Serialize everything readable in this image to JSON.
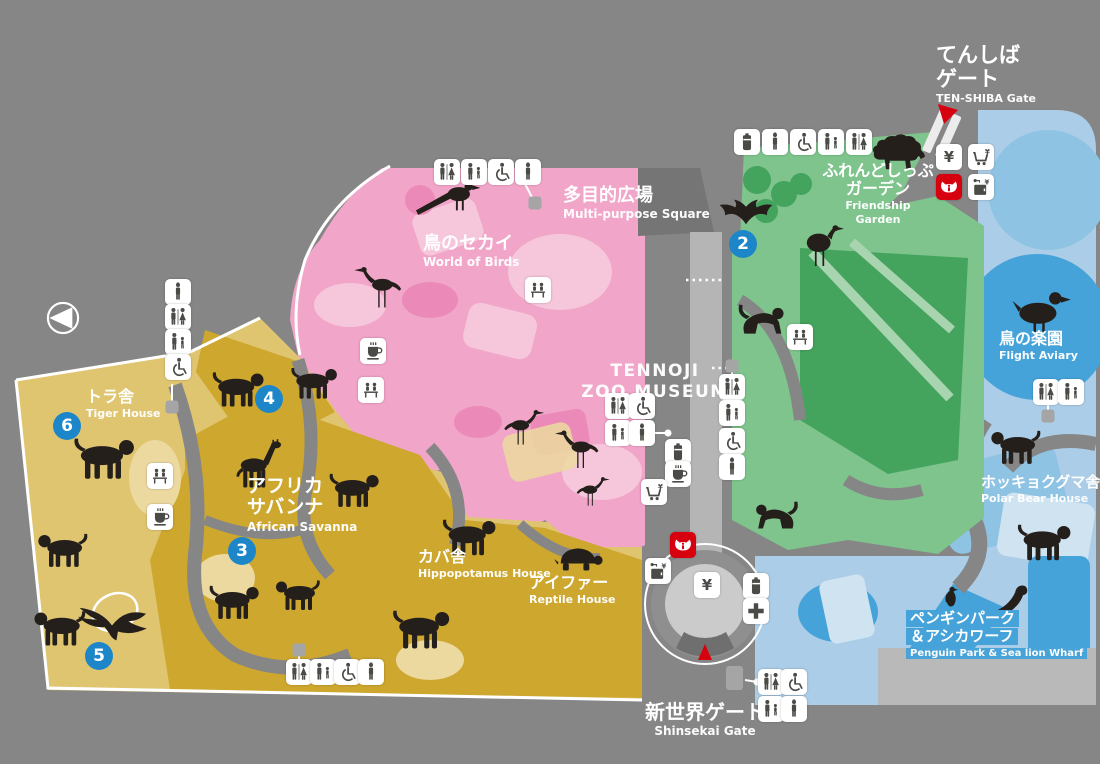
{
  "map": {
    "name": "Tennoji Zoo guide map",
    "colors": {
      "bg": "#868686",
      "corridor_dark": "#757575",
      "road_light": "#b5b5b5",
      "plaza_ring": "#8f8f8f",
      "plaza_inner": "#cbcbcb",
      "plaza_steps": "#6f6f6f",
      "concrete": "#b9b9b9",
      "pink": "#f1a5c9",
      "pink_light": "#f6c6db",
      "pink_dark": "#eb8ab8",
      "yellow": "#cda72e",
      "yellow_light": "#e0c571",
      "yellow_pale": "#ecd99f",
      "green": "#7ec48c",
      "green_dark": "#44a35d",
      "green_pale": "#a8d5b0",
      "blue_bg": "#abcde7",
      "blue_mid": "#45a3da",
      "blue_soft": "#8fc3e4",
      "blue_pale": "#cfe3f1",
      "ink": "#241f1b",
      "glyph": "#4a4a46",
      "marker_blue": "#1d86c8",
      "red": "#d7000f"
    },
    "compass": {
      "x": 63,
      "y": 318
    },
    "labels": [
      {
        "id": "tenshiba-gate",
        "ja": [
          "てんしば",
          "ゲート"
        ],
        "en": "TEN-SHIBA Gate",
        "x": 936,
        "y": 44,
        "ja_size": 21,
        "en_size": 11,
        "align": "left"
      },
      {
        "id": "friendship-garden",
        "ja": [
          "ふれんどしっぷ",
          "ガーデン"
        ],
        "en": [
          "Friendship",
          "Garden"
        ],
        "x": 878,
        "y": 162,
        "ja_size": 16,
        "en_size": 11,
        "align": "center"
      },
      {
        "id": "multi-purpose-square",
        "ja": [
          "多目的広場"
        ],
        "en": "Multi-purpose Square",
        "x": 563,
        "y": 186,
        "ja_size": 18,
        "en_size": 12,
        "align": "left"
      },
      {
        "id": "world-of-birds",
        "ja": [
          "鳥のセカイ"
        ],
        "en": "World of Birds",
        "x": 423,
        "y": 234,
        "ja_size": 18,
        "en_size": 12,
        "align": "left"
      },
      {
        "id": "zoo-museum",
        "ja": [],
        "en": [
          "TENNOJI",
          "ZOO MUSEUM"
        ],
        "x": 655,
        "y": 360,
        "ja_size": 0,
        "en_size": 17,
        "align": "center"
      },
      {
        "id": "tiger-house",
        "ja": [
          "トラ舎"
        ],
        "en": "Tiger House",
        "x": 86,
        "y": 388,
        "ja_size": 16,
        "en_size": 11,
        "align": "left"
      },
      {
        "id": "african-savanna",
        "ja": [
          "アフリカ",
          "サバンナ"
        ],
        "en": "African Savanna",
        "x": 247,
        "y": 476,
        "ja_size": 19,
        "en_size": 12,
        "align": "left"
      },
      {
        "id": "hippopotamus-house",
        "ja": [
          "カバ舎"
        ],
        "en": "Hippopotamus House",
        "x": 418,
        "y": 548,
        "ja_size": 16,
        "en_size": 11,
        "align": "left"
      },
      {
        "id": "reptile-house",
        "ja": [
          "アイファー"
        ],
        "en": "Reptile House",
        "x": 529,
        "y": 574,
        "ja_size": 16,
        "en_size": 11,
        "align": "left"
      },
      {
        "id": "flight-aviary",
        "ja": [
          "鳥の楽園"
        ],
        "en": "Flight Aviary",
        "x": 999,
        "y": 330,
        "ja_size": 16,
        "en_size": 11,
        "align": "left"
      },
      {
        "id": "polar-bear-house",
        "ja": [
          "ホッキョクグマ舎"
        ],
        "en": "Polar Bear House",
        "x": 981,
        "y": 474,
        "ja_size": 15,
        "en_size": 11,
        "align": "left"
      },
      {
        "id": "penguin-park",
        "ja": [
          "ペンギンパーク",
          "＆アシカワーフ"
        ],
        "en": "Penguin Park & Sea lion Wharf",
        "x": 906,
        "y": 610,
        "ja_size": 15,
        "en_size": 10,
        "align": "left",
        "highlight": true
      },
      {
        "id": "shinsekai-gate",
        "ja": [
          "新世界ゲート"
        ],
        "en": "Shinsekai Gate",
        "x": 705,
        "y": 701,
        "ja_size": 20,
        "en_size": 12,
        "align": "center"
      }
    ],
    "markers": [
      {
        "n": "2",
        "x": 743,
        "y": 244
      },
      {
        "n": "3",
        "x": 242,
        "y": 551
      },
      {
        "n": "4",
        "x": 269,
        "y": 399
      },
      {
        "n": "5",
        "x": 99,
        "y": 656
      },
      {
        "n": "6",
        "x": 67,
        "y": 426
      }
    ],
    "facilities": [
      {
        "type": "ticket",
        "x": 949,
        "y": 157
      },
      {
        "type": "shop",
        "x": 981,
        "y": 157
      },
      {
        "type": "info",
        "x": 949,
        "y": 187
      },
      {
        "type": "locker",
        "x": 981,
        "y": 187
      },
      {
        "type": "vending",
        "x": 747,
        "y": 142
      },
      {
        "type": "toilet",
        "x": 775,
        "y": 142
      },
      {
        "type": "wheelchair",
        "x": 803,
        "y": 142
      },
      {
        "type": "baby",
        "x": 831,
        "y": 142
      },
      {
        "type": "toilet_mw",
        "x": 859,
        "y": 142
      },
      {
        "type": "toilet_mw",
        "x": 447,
        "y": 172
      },
      {
        "type": "baby",
        "x": 474,
        "y": 172
      },
      {
        "type": "wheelchair",
        "x": 501,
        "y": 172
      },
      {
        "type": "toilet",
        "x": 528,
        "y": 172
      },
      {
        "type": "toilet",
        "x": 178,
        "y": 292
      },
      {
        "type": "toilet_mw",
        "x": 178,
        "y": 317
      },
      {
        "type": "baby",
        "x": 178,
        "y": 342
      },
      {
        "type": "wheelchair",
        "x": 178,
        "y": 367
      },
      {
        "type": "viewpoint",
        "x": 160,
        "y": 476
      },
      {
        "type": "cafe",
        "x": 160,
        "y": 517
      },
      {
        "type": "cafe",
        "x": 373,
        "y": 351
      },
      {
        "type": "viewpoint",
        "x": 371,
        "y": 390
      },
      {
        "type": "viewpoint",
        "x": 538,
        "y": 290
      },
      {
        "type": "toilet_mw",
        "x": 618,
        "y": 406
      },
      {
        "type": "wheelchair",
        "x": 642,
        "y": 406
      },
      {
        "type": "baby",
        "x": 618,
        "y": 433
      },
      {
        "type": "toilet",
        "x": 642,
        "y": 433
      },
      {
        "type": "vending",
        "x": 678,
        "y": 452
      },
      {
        "type": "cafe",
        "x": 678,
        "y": 474
      },
      {
        "type": "shop",
        "x": 654,
        "y": 492
      },
      {
        "type": "toilet_mw",
        "x": 732,
        "y": 387
      },
      {
        "type": "baby",
        "x": 732,
        "y": 413
      },
      {
        "type": "wheelchair",
        "x": 732,
        "y": 441
      },
      {
        "type": "toilet",
        "x": 732,
        "y": 467
      },
      {
        "type": "viewpoint",
        "x": 800,
        "y": 337
      },
      {
        "type": "toilet_mw",
        "x": 1046,
        "y": 392
      },
      {
        "type": "baby",
        "x": 1071,
        "y": 392
      },
      {
        "type": "info",
        "x": 683,
        "y": 545
      },
      {
        "type": "locker",
        "x": 658,
        "y": 571
      },
      {
        "type": "ticket",
        "x": 707,
        "y": 585
      },
      {
        "type": "vending",
        "x": 756,
        "y": 586
      },
      {
        "type": "firstaid",
        "x": 756,
        "y": 611
      },
      {
        "type": "toilet_mw",
        "x": 771,
        "y": 682
      },
      {
        "type": "wheelchair",
        "x": 794,
        "y": 682
      },
      {
        "type": "baby",
        "x": 771,
        "y": 709
      },
      {
        "type": "toilet",
        "x": 794,
        "y": 709
      },
      {
        "type": "toilet_mw",
        "x": 299,
        "y": 672
      },
      {
        "type": "baby",
        "x": 323,
        "y": 672
      },
      {
        "type": "wheelchair",
        "x": 347,
        "y": 672
      },
      {
        "type": "toilet",
        "x": 371,
        "y": 672
      }
    ],
    "animals": [
      {
        "kind": "pheasant",
        "x": 450,
        "y": 203,
        "w": 74,
        "flip": false
      },
      {
        "kind": "longbird",
        "x": 378,
        "y": 288,
        "w": 54,
        "flip": true
      },
      {
        "kind": "longbird",
        "x": 524,
        "y": 428,
        "w": 46,
        "flip": false
      },
      {
        "kind": "longbird",
        "x": 577,
        "y": 450,
        "w": 50,
        "flip": true
      },
      {
        "kind": "longbird",
        "x": 593,
        "y": 492,
        "w": 38,
        "flip": false
      },
      {
        "kind": "sheep",
        "x": 898,
        "y": 150,
        "w": 60,
        "flip": false
      },
      {
        "kind": "bat",
        "x": 746,
        "y": 214,
        "w": 60,
        "flip": false
      },
      {
        "kind": "ostrich",
        "x": 823,
        "y": 246,
        "w": 54,
        "flip": false
      },
      {
        "kind": "monkey",
        "x": 760,
        "y": 318,
        "w": 56,
        "flip": false
      },
      {
        "kind": "monkey",
        "x": 778,
        "y": 514,
        "w": 52,
        "flip": true
      },
      {
        "kind": "quadruped",
        "x": 238,
        "y": 388,
        "w": 58,
        "flip": false
      },
      {
        "kind": "quadruped",
        "x": 314,
        "y": 382,
        "w": 52,
        "flip": false
      },
      {
        "kind": "giraffe",
        "x": 260,
        "y": 464,
        "w": 62,
        "flip": false
      },
      {
        "kind": "quadruped",
        "x": 354,
        "y": 489,
        "w": 56,
        "flip": false
      },
      {
        "kind": "quadruped",
        "x": 104,
        "y": 457,
        "w": 68,
        "flip": false
      },
      {
        "kind": "quadruped",
        "x": 63,
        "y": 549,
        "w": 56,
        "flip": true
      },
      {
        "kind": "quadruped",
        "x": 60,
        "y": 627,
        "w": 58,
        "flip": true
      },
      {
        "kind": "eagle",
        "x": 112,
        "y": 630,
        "w": 74,
        "flip": false
      },
      {
        "kind": "quadruped",
        "x": 234,
        "y": 601,
        "w": 56,
        "flip": false
      },
      {
        "kind": "quadruped",
        "x": 298,
        "y": 594,
        "w": 50,
        "flip": true
      },
      {
        "kind": "quadruped",
        "x": 421,
        "y": 628,
        "w": 64,
        "flip": false
      },
      {
        "kind": "quadruped",
        "x": 469,
        "y": 536,
        "w": 60,
        "flip": false
      },
      {
        "kind": "turtle",
        "x": 578,
        "y": 557,
        "w": 54,
        "flip": false
      },
      {
        "kind": "duck",
        "x": 1041,
        "y": 312,
        "w": 62,
        "flip": false
      },
      {
        "kind": "quadruped",
        "x": 1016,
        "y": 446,
        "w": 56,
        "flip": true
      },
      {
        "kind": "quadruped",
        "x": 1044,
        "y": 541,
        "w": 60,
        "flip": false
      },
      {
        "kind": "penguin",
        "x": 951,
        "y": 597,
        "w": 28,
        "flip": false
      },
      {
        "kind": "sealion",
        "x": 1002,
        "y": 603,
        "w": 60,
        "flip": false
      }
    ],
    "connectors": [
      {
        "px": 535,
        "py": 203,
        "x2": 524,
        "y2": 182,
        "pin": "square"
      },
      {
        "px": 172,
        "py": 407,
        "x2": 172,
        "y2": 384,
        "pin": "square"
      },
      {
        "px": 668,
        "py": 433,
        "x2": 655,
        "y2": 433,
        "pin": "dot"
      },
      {
        "px": 732,
        "py": 366,
        "x2": 732,
        "y2": 382,
        "pin": "square"
      },
      {
        "px": 1048,
        "py": 416,
        "x2": 1048,
        "y2": 405,
        "pin": "square"
      },
      {
        "px": 757,
        "py": 682,
        "x2": 745,
        "y2": 680,
        "pin": "dot"
      },
      {
        "px": 299,
        "py": 650,
        "x2": 299,
        "y2": 661,
        "pin": "square"
      }
    ]
  }
}
